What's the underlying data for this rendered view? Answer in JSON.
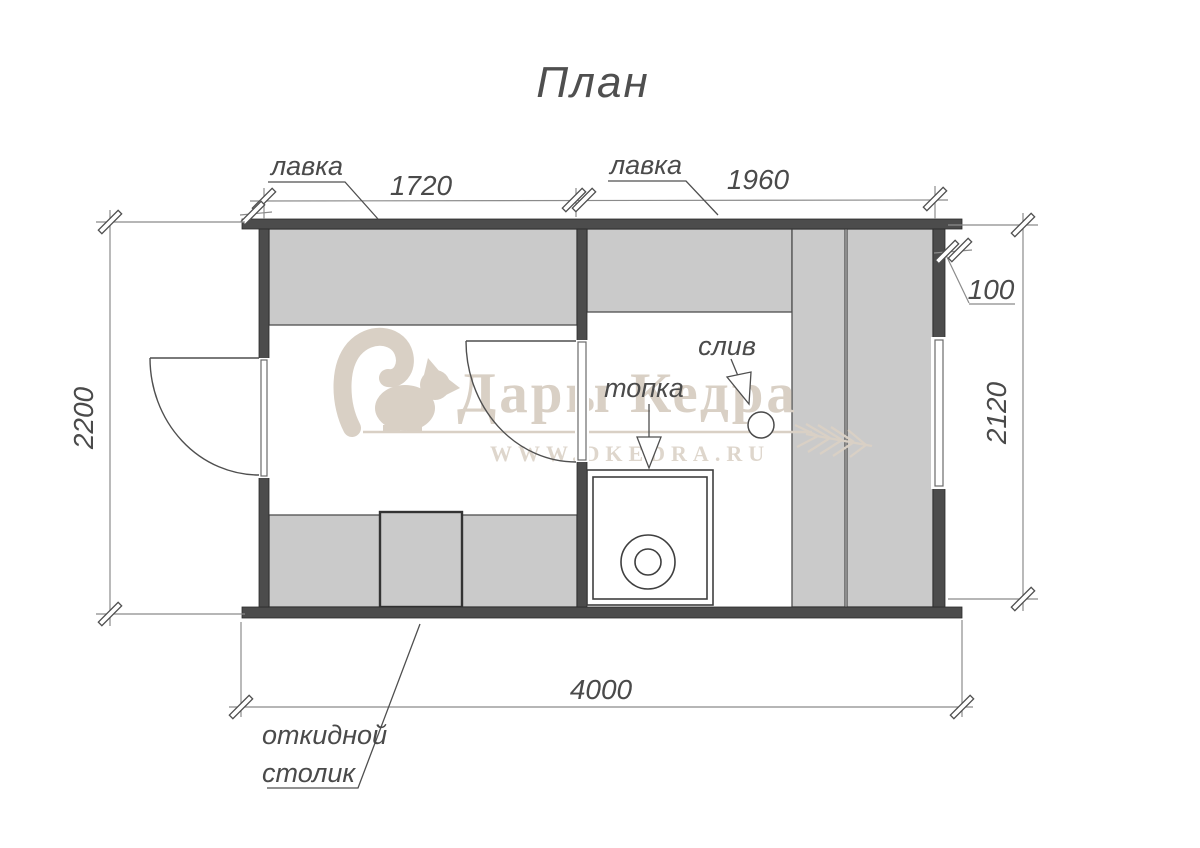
{
  "title": "План",
  "watermark": {
    "brand": "Дары Кедра",
    "site": "WWW.DKEDRA.RU"
  },
  "labels": {
    "bench_left": "лавка",
    "bench_right": "лавка",
    "firebox": "топка",
    "drain": "слив",
    "folding_table_line1": "откидной",
    "folding_table_line2": "столик"
  },
  "dims": {
    "left_room_width": "1720",
    "right_room_width": "1960",
    "overall_width": "4000",
    "overall_depth": "2200",
    "inner_depth": "2120",
    "wall_offset": "100"
  },
  "colors": {
    "wall": "#4c4c4c",
    "bench": "#cacaca",
    "line": "#4f4f4f",
    "watermark": "#d9d0c5",
    "background": "#ffffff"
  }
}
